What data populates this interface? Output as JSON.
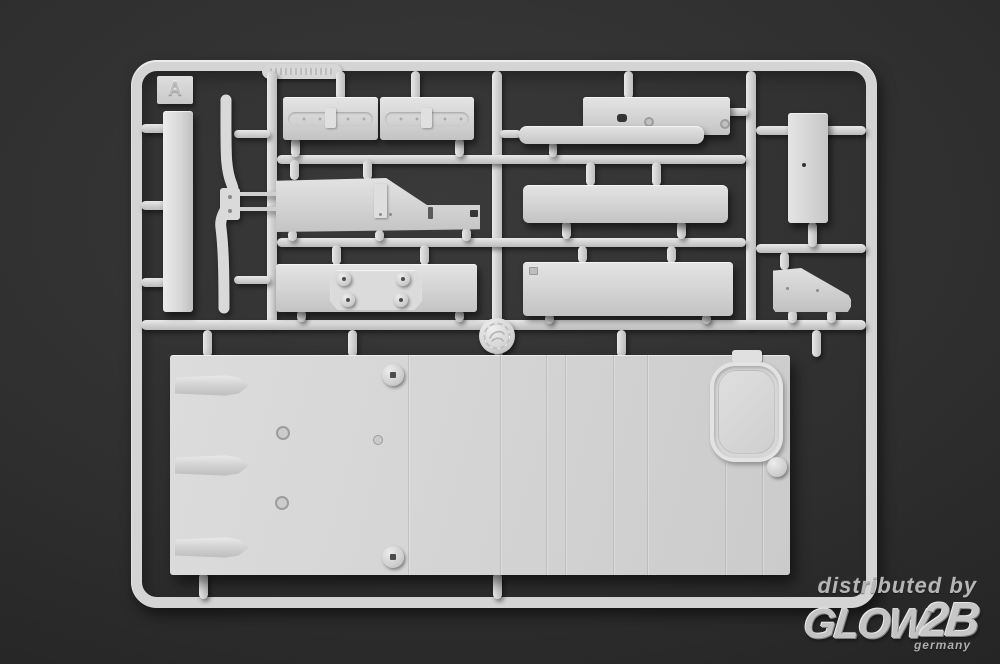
{
  "scene": {
    "description": "Photograph of a light gray injection-molded plastic model kit sprue on a dark charcoal studio background",
    "sprue_letter": "A"
  },
  "sprue": {
    "letter": "A",
    "molded_code_plate": "illegible embossed part-number plate on top rail",
    "medallion": "circular embossed brand medallion at central runner junction",
    "parts": [
      {
        "id": "vertical-plank",
        "desc": "tall narrow plank, far left column"
      },
      {
        "id": "curved-strip",
        "desc": "S-curved strip with two cross pins, left column"
      },
      {
        "id": "skirt-left",
        "desc": "horizontal skirt section with riveted groove band"
      },
      {
        "id": "skirt-right",
        "desc": "horizontal skirt section with riveted groove band"
      },
      {
        "id": "stepped-beam",
        "desc": "stepped beam with slot and two holes, top right"
      },
      {
        "id": "right-panel",
        "desc": "vertical rectangular panel, far right"
      },
      {
        "id": "sloped-side-panel",
        "desc": "side panel with diagonal slope and fittings"
      },
      {
        "id": "plain-bar-upper",
        "desc": "plain rectangular bar, middle right"
      },
      {
        "id": "mount-plate",
        "desc": "plate with octagonal pad and four round bosses"
      },
      {
        "id": "plain-bar-lower",
        "desc": "plain rectangular bar with corner notch"
      },
      {
        "id": "wedge-bracket",
        "desc": "small wedge-shaped bracket, lower right"
      },
      {
        "id": "deck-plate",
        "desc": "large deck plate with panel lines, oval hatch, screw bosses, three pointed ridges"
      }
    ]
  },
  "watermark": {
    "distributed_by": "distributed by",
    "brand_main": "GLOW",
    "brand_suffix": "2B",
    "country": "germany"
  },
  "colors": {
    "background": "#2d2d2d",
    "plastic": "#d6d6d6",
    "plastic_highlight": "#eeeeee",
    "plastic_shadow": "#b5b5b5",
    "watermark": "#bdbdbd"
  }
}
